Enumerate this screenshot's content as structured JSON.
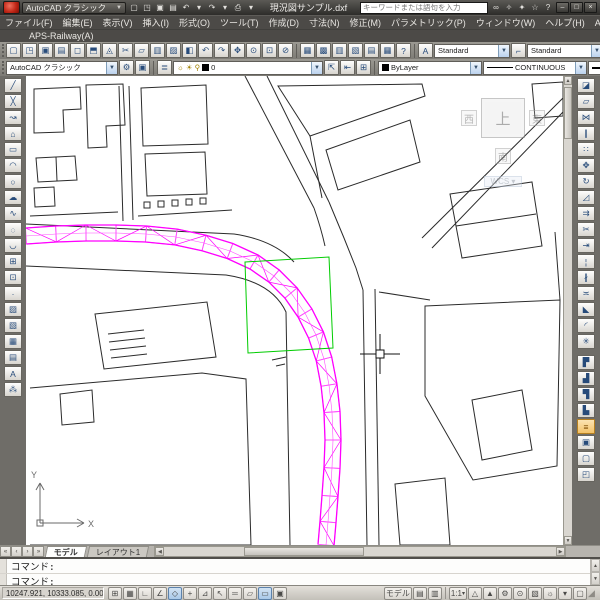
{
  "window": {
    "doc_title": "現況図サンプル.dxf",
    "search_placeholder": "キーワードまたは語句を入力",
    "workspace": "AutoCAD クラシック"
  },
  "titlebar": {
    "quick_access": [
      {
        "name": "new-button",
        "glyph": "▢",
        "label": "新規作成"
      },
      {
        "name": "open-button",
        "glyph": "◳",
        "label": "開く"
      },
      {
        "name": "save-button",
        "glyph": "▣",
        "label": "上書き保存"
      },
      {
        "name": "plot-button",
        "glyph": "▤",
        "label": "印刷"
      },
      {
        "name": "undo-button",
        "glyph": "↶",
        "label": "元に戻す"
      },
      {
        "name": "undo-dropdown-arrow",
        "glyph": "▾"
      },
      {
        "name": "redo-button",
        "glyph": "↷",
        "label": "やり直し"
      },
      {
        "name": "redo-dropdown-arrow",
        "glyph": "▾"
      },
      {
        "name": "print-button",
        "glyph": "⎙",
        "label": "出力"
      },
      {
        "name": "print-dropdown-arrow",
        "glyph": "▾"
      }
    ],
    "right_icons": [
      {
        "name": "search-binoculars-icon",
        "glyph": "∞"
      },
      {
        "name": "subscription-key-icon",
        "glyph": "✧"
      },
      {
        "name": "communication-center-icon",
        "glyph": "✦"
      },
      {
        "name": "favorites-star-icon",
        "glyph": "☆"
      },
      {
        "name": "help-icon",
        "glyph": "?"
      }
    ],
    "window_buttons": [
      {
        "name": "minimize-button",
        "glyph": "–"
      },
      {
        "name": "restore-button",
        "glyph": "□"
      },
      {
        "name": "close-button",
        "glyph": "×"
      }
    ]
  },
  "menubar": {
    "items": [
      {
        "name": "menu-file",
        "label": "ファイル(F)"
      },
      {
        "name": "menu-edit",
        "label": "編集(E)"
      },
      {
        "name": "menu-view",
        "label": "表示(V)"
      },
      {
        "name": "menu-insert",
        "label": "挿入(I)"
      },
      {
        "name": "menu-format",
        "label": "形式(O)"
      },
      {
        "name": "menu-tools",
        "label": "ツール(T)"
      },
      {
        "name": "menu-draw",
        "label": "作成(D)"
      },
      {
        "name": "menu-dimension",
        "label": "寸法(N)"
      },
      {
        "name": "menu-modify",
        "label": "修正(M)"
      },
      {
        "name": "menu-parametric",
        "label": "パラメトリック(P)"
      },
      {
        "name": "menu-window",
        "label": "ウィンドウ(W)"
      },
      {
        "name": "menu-help",
        "label": "ヘルプ(H)"
      },
      {
        "name": "menu-aps-k",
        "label": "APS-K(K)"
      }
    ],
    "doc_window_buttons": [
      {
        "name": "doc-minimize-button",
        "glyph": "–"
      },
      {
        "name": "doc-restore-button",
        "glyph": "❐"
      },
      {
        "name": "doc-close-button",
        "glyph": "×"
      }
    ]
  },
  "menubar2": {
    "items": [
      {
        "name": "menu-aps-railway",
        "label": "APS-Railway(A)"
      }
    ]
  },
  "toolbar_standard": {
    "buttons": [
      {
        "name": "qnew-button",
        "glyph": "▢"
      },
      {
        "name": "open-file-button",
        "glyph": "◳"
      },
      {
        "name": "save-file-button",
        "glyph": "▣"
      },
      {
        "name": "plot-file-button",
        "glyph": "▤"
      },
      {
        "name": "plot-preview-button",
        "glyph": "◻"
      },
      {
        "name": "publish-button",
        "glyph": "⬒"
      },
      {
        "name": "3ddwf-button",
        "glyph": "◬"
      },
      {
        "name": "cut-button",
        "glyph": "✂"
      },
      {
        "name": "copy-button",
        "glyph": "▱"
      },
      {
        "name": "paste-button",
        "glyph": "▥"
      },
      {
        "name": "match-properties-button",
        "glyph": "▨"
      },
      {
        "name": "block-editor-button",
        "glyph": "◧"
      },
      {
        "name": "undo-tool-button",
        "glyph": "↶"
      },
      {
        "name": "redo-tool-button",
        "glyph": "↷"
      },
      {
        "name": "pan-button",
        "glyph": "✥"
      },
      {
        "name": "zoom-realtime-button",
        "glyph": "⊙"
      },
      {
        "name": "zoom-window-button",
        "glyph": "⊡"
      },
      {
        "name": "zoom-previous-button",
        "glyph": "⊘"
      }
    ],
    "palette_buttons": [
      {
        "name": "properties-palette-button",
        "glyph": "▦"
      },
      {
        "name": "designcenter-button",
        "glyph": "▩"
      },
      {
        "name": "tool-palettes-button",
        "glyph": "▥"
      },
      {
        "name": "sheet-set-manager-button",
        "glyph": "▧"
      },
      {
        "name": "markup-set-manager-button",
        "glyph": "▤"
      },
      {
        "name": "quickcalc-button",
        "glyph": "▦"
      },
      {
        "name": "help-tool-button",
        "glyph": "?"
      }
    ],
    "text_style_label": "Standard",
    "dim_style_label": "Standard",
    "table_style_label": "Standard"
  },
  "toolbar_layers": {
    "workspace_label": "AutoCAD クラシック",
    "workspace_buttons": [
      {
        "name": "workspace-settings-button",
        "glyph": "⚙"
      },
      {
        "name": "workspace-save-button",
        "glyph": "▣"
      }
    ],
    "layer_properties_button": {
      "name": "layer-properties-button",
      "glyph": "≣"
    },
    "layer_icons": [
      {
        "name": "layer-on-bulb-icon",
        "glyph": "☼"
      },
      {
        "name": "layer-freeze-sun-icon",
        "glyph": "☀"
      },
      {
        "name": "layer-lock-icon",
        "glyph": "⚲"
      }
    ],
    "layer_name": "0",
    "layer_buttons": [
      {
        "name": "make-object-layer-current-button",
        "glyph": "⇱"
      },
      {
        "name": "layer-previous-button",
        "glyph": "⇤"
      },
      {
        "name": "layer-states-button",
        "glyph": "⊞"
      }
    ],
    "color_label": "ByLayer",
    "linetype_label": "CONTINUOUS"
  },
  "draw_toolbar": {
    "buttons": [
      {
        "name": "line-button",
        "glyph": "╱"
      },
      {
        "name": "construction-line-button",
        "glyph": "╳"
      },
      {
        "name": "polyline-button",
        "glyph": "↝"
      },
      {
        "name": "polygon-button",
        "glyph": "⌂"
      },
      {
        "name": "rectangle-button",
        "glyph": "▭"
      },
      {
        "name": "arc-button",
        "glyph": "◠"
      },
      {
        "name": "circle-button",
        "glyph": "○"
      },
      {
        "name": "revision-cloud-button",
        "glyph": "☁"
      },
      {
        "name": "spline-button",
        "glyph": "∿"
      },
      {
        "name": "ellipse-button",
        "glyph": "◌"
      },
      {
        "name": "ellipse-arc-button",
        "glyph": "◡"
      },
      {
        "name": "insert-block-button",
        "glyph": "⊞"
      },
      {
        "name": "make-block-button",
        "glyph": "⊡"
      },
      {
        "name": "point-button",
        "glyph": "∙"
      },
      {
        "name": "hatch-button",
        "glyph": "▨"
      },
      {
        "name": "gradient-button",
        "glyph": "▧"
      },
      {
        "name": "region-button",
        "glyph": "▦"
      },
      {
        "name": "table-button",
        "glyph": "▤"
      },
      {
        "name": "mtext-button",
        "glyph": "A"
      },
      {
        "name": "misc-tool-button",
        "glyph": "⁂"
      }
    ]
  },
  "modify_toolbar": {
    "buttons": [
      {
        "name": "erase-button",
        "glyph": "◪"
      },
      {
        "name": "copy-object-button",
        "glyph": "▱"
      },
      {
        "name": "mirror-button",
        "glyph": "⋈"
      },
      {
        "name": "offset-button",
        "glyph": "∥"
      },
      {
        "name": "array-button",
        "glyph": "∷"
      },
      {
        "name": "move-button",
        "glyph": "✥"
      },
      {
        "name": "rotate-button",
        "glyph": "↻"
      },
      {
        "name": "scale-button",
        "glyph": "◿"
      },
      {
        "name": "stretch-button",
        "glyph": "⇉"
      },
      {
        "name": "trim-button",
        "glyph": "✂"
      },
      {
        "name": "extend-button",
        "glyph": "⇥"
      },
      {
        "name": "break-at-point-button",
        "glyph": "¦"
      },
      {
        "name": "break-button",
        "glyph": "∦"
      },
      {
        "name": "join-button",
        "glyph": "≍"
      },
      {
        "name": "chamfer-button",
        "glyph": "◣"
      },
      {
        "name": "fillet-button",
        "glyph": "◜"
      },
      {
        "name": "explode-button",
        "glyph": "✳"
      }
    ],
    "draworder_buttons": [
      {
        "name": "bring-to-front-button",
        "glyph": "▛"
      },
      {
        "name": "send-to-back-button",
        "glyph": "▟"
      },
      {
        "name": "bring-above-objects-button",
        "glyph": "▜"
      },
      {
        "name": "send-under-objects-button",
        "glyph": "▙"
      },
      {
        "name": "text-to-front-button",
        "glyph": "≡",
        "active": true
      },
      {
        "name": "annotation-lock-button",
        "glyph": "▣"
      },
      {
        "name": "hatch-to-back-button",
        "glyph": "▢"
      },
      {
        "name": "draworder-group-button",
        "glyph": "◰"
      }
    ]
  },
  "viewcube": {
    "west": "西",
    "top": "上",
    "east": "東",
    "south": "南",
    "wcs": "WCS"
  },
  "ucs": {
    "x_label": "X",
    "y_label": "Y"
  },
  "tabs": {
    "nav": [
      {
        "name": "tab-first-button",
        "glyph": "«"
      },
      {
        "name": "tab-prev-button",
        "glyph": "‹"
      },
      {
        "name": "tab-next-button",
        "glyph": "›"
      },
      {
        "name": "tab-last-button",
        "glyph": "»"
      }
    ],
    "model_label": "モデル",
    "layout1_label": "レイアウト1"
  },
  "command": {
    "line1": "コマンド:",
    "line2": "コマンド:"
  },
  "statusbar": {
    "coords": "10247.921, 10333.085, 0.0000",
    "toggles": [
      {
        "name": "snap-toggle",
        "glyph": "⊞"
      },
      {
        "name": "grid-toggle",
        "glyph": "▦"
      },
      {
        "name": "ortho-toggle",
        "glyph": "∟"
      },
      {
        "name": "polar-toggle",
        "glyph": "∠"
      },
      {
        "name": "osnap-toggle",
        "glyph": "◇",
        "active": true
      },
      {
        "name": "otrack-toggle",
        "glyph": "+"
      },
      {
        "name": "ducs-toggle",
        "glyph": "⊿"
      },
      {
        "name": "dyn-toggle",
        "glyph": "↖"
      },
      {
        "name": "lwt-toggle",
        "glyph": "═"
      },
      {
        "name": "transparency-toggle",
        "glyph": "▱"
      },
      {
        "name": "qp-toggle",
        "glyph": "▭",
        "active": true
      },
      {
        "name": "sc-toggle",
        "glyph": "▣"
      }
    ],
    "model_label": "モデル",
    "right_icons_a": [
      {
        "name": "quick-view-drawings-button",
        "glyph": "▤"
      },
      {
        "name": "quick-view-layouts-button",
        "glyph": "▥"
      }
    ],
    "annotation_scale": "1:1",
    "right_icons_b": [
      {
        "name": "annotation-visibility-button",
        "glyph": "△"
      },
      {
        "name": "annotation-autoscale-button",
        "glyph": "▲"
      },
      {
        "name": "workspace-switching-button",
        "glyph": "⚙"
      },
      {
        "name": "toolbar-lock-button",
        "glyph": "⊙"
      },
      {
        "name": "status-tray-button",
        "glyph": "▧"
      },
      {
        "name": "performance-tuner-button",
        "glyph": "☼"
      },
      {
        "name": "tray-dropdown-arrow",
        "glyph": "▾"
      },
      {
        "name": "clean-screen-button",
        "glyph": "▢"
      }
    ]
  },
  "colors": {
    "rail_magenta": "#ff00ff",
    "rail_light": "#ff4dff",
    "selection_green": "#00cc00",
    "linework_black": "#2b2b2b",
    "ucs_gray": "#6a6a6a"
  }
}
